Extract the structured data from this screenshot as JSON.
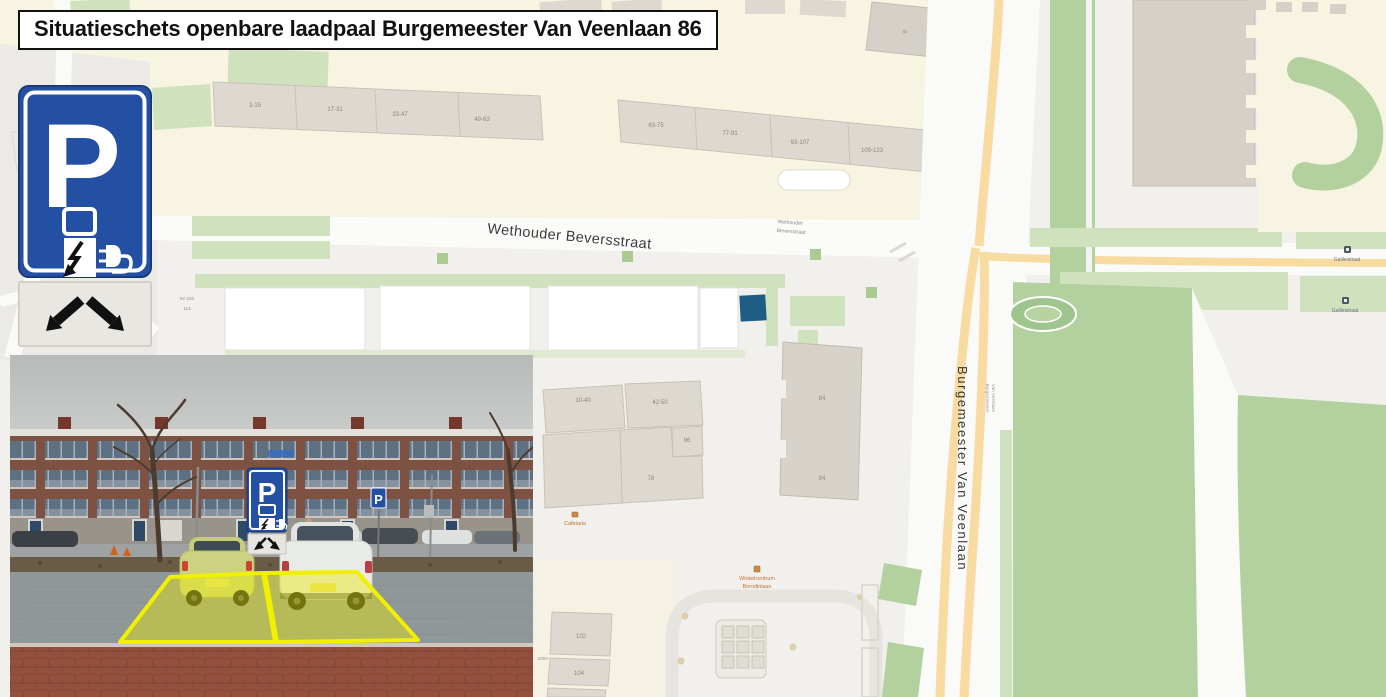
{
  "title": "Situatieschets openbare laadpaal Burgemeester Van Veenlaan 86",
  "sign": {
    "letter": "P"
  },
  "colors": {
    "marker": "#1F5E84",
    "sign_blue": "#2450A4",
    "highlight_yellow": "#F0F000",
    "grass": "#B3D19F",
    "grass_light": "#CFE1BD",
    "road_yellow": "#F8DBA0"
  },
  "map": {
    "street_main": "Wethouder Beversstraat",
    "street_main_small": {
      "line1": "Wethouder",
      "line2": "Beversstraat"
    },
    "street_vertical": "Burgemeester Van Veenlaan",
    "street_vertical_small": {
      "line1": "Burgemeester",
      "line2": "Van Veenlaan"
    },
    "bus_stops": [
      {
        "label": "Galileistraat"
      },
      {
        "label": "Galileistraat"
      }
    ],
    "poi_shopping": {
      "line1": "Winkelcentrum",
      "line2": "Borodinlaan"
    },
    "poi_small": "Cafetaria",
    "house_numbers_row1": [
      "3-15",
      "17-31",
      "33-47",
      "49-63"
    ],
    "house_numbers_row2": [
      "63-75",
      "77-91",
      "93-107",
      "109-123"
    ],
    "house_numbers_mid": [
      "10-40",
      "42-50",
      "96",
      "78",
      "84",
      "94",
      "82"
    ],
    "house_numbers_bottom": [
      "100A",
      "102",
      "104"
    ],
    "small_labels": [
      "52-102",
      "114"
    ]
  }
}
